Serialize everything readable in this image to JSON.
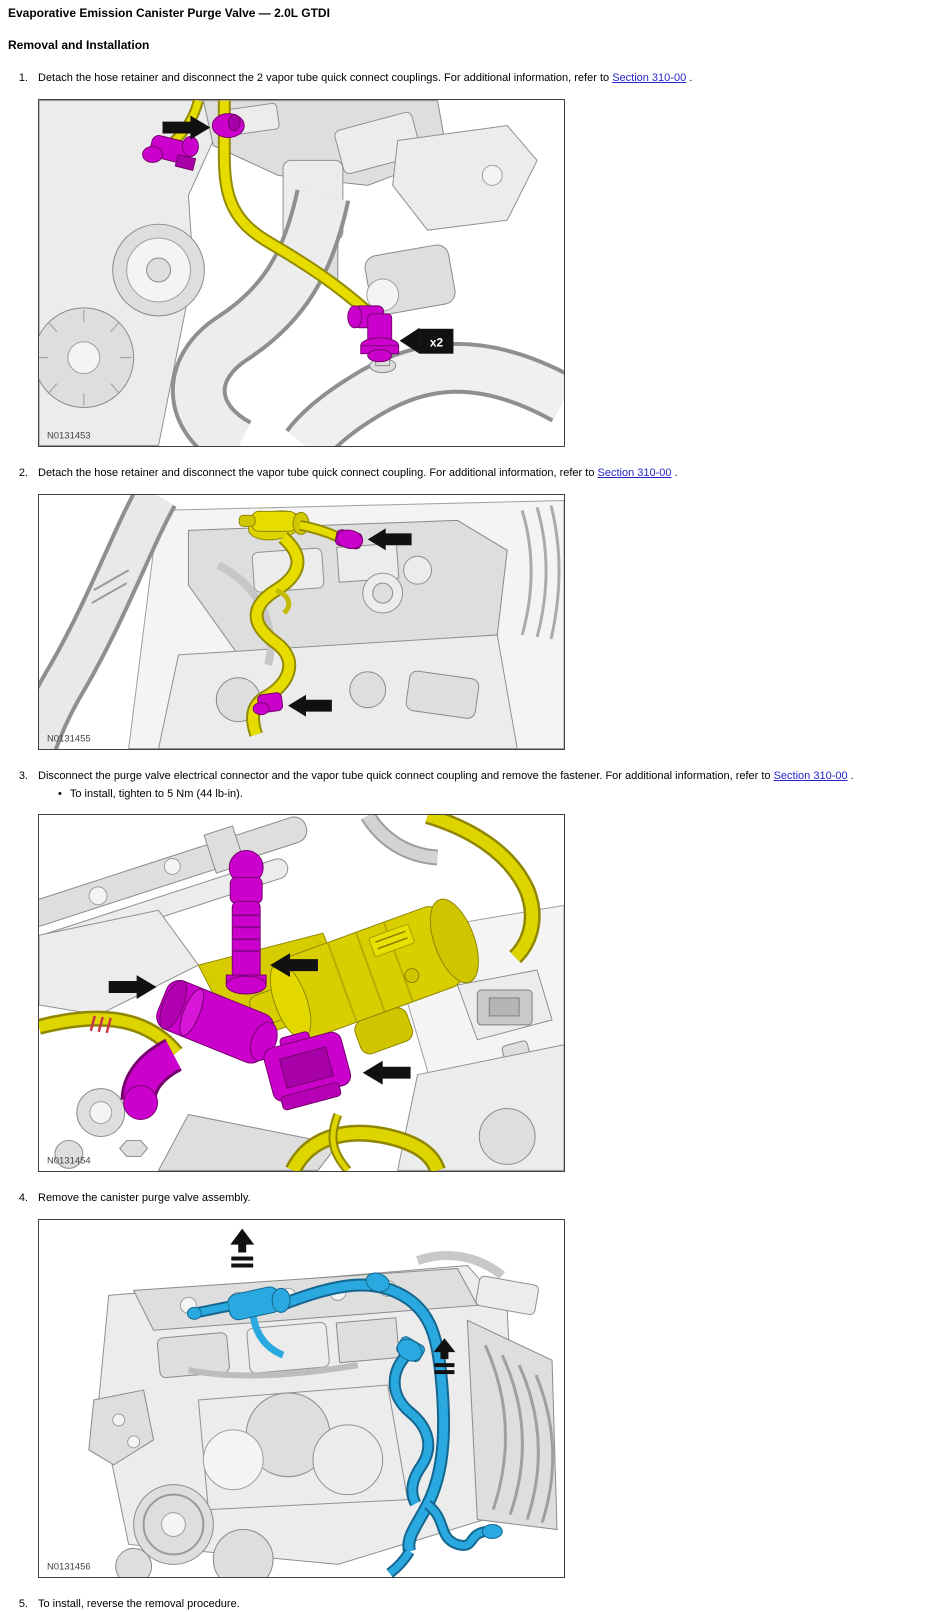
{
  "page": {
    "title": "Evaporative Emission Canister Purge Valve — 2.0L GTDI",
    "heading": "Removal and Installation",
    "bullet_glyph": "•"
  },
  "colors": {
    "link": "#2525cb",
    "highlight_magenta": "#cc00cc",
    "highlight_yellow": "#ddd400",
    "highlight_blue": "#2aa9e0",
    "arrow_black": "#111111"
  },
  "steps": [
    {
      "number": "1.",
      "text": "Detach the hose retainer and disconnect the 2 vapor tube quick connect couplings. For additional information, refer to ",
      "link_text": "Section 310-00",
      "text_after": " .",
      "figure_label": "N0131453",
      "badge": "x2"
    },
    {
      "number": "2.",
      "text": "Detach the hose retainer and disconnect the vapor tube quick connect coupling. For additional information, refer to ",
      "link_text": "Section 310-00",
      "text_after": " .",
      "figure_label": "N0131455"
    },
    {
      "number": "3.",
      "text": "Disconnect the purge valve electrical connector and the vapor tube quick connect coupling and remove the fastener. For additional information, refer to ",
      "link_text": "Section 310-00",
      "text_after": " .",
      "bullet": "To install, tighten to 5 Nm (44 lb-in).",
      "figure_label": "N0131454"
    },
    {
      "number": "4.",
      "text": "Remove the canister purge valve assembly.",
      "figure_label": "N0131456"
    },
    {
      "number": "5.",
      "text": "To install, reverse the removal procedure."
    }
  ]
}
